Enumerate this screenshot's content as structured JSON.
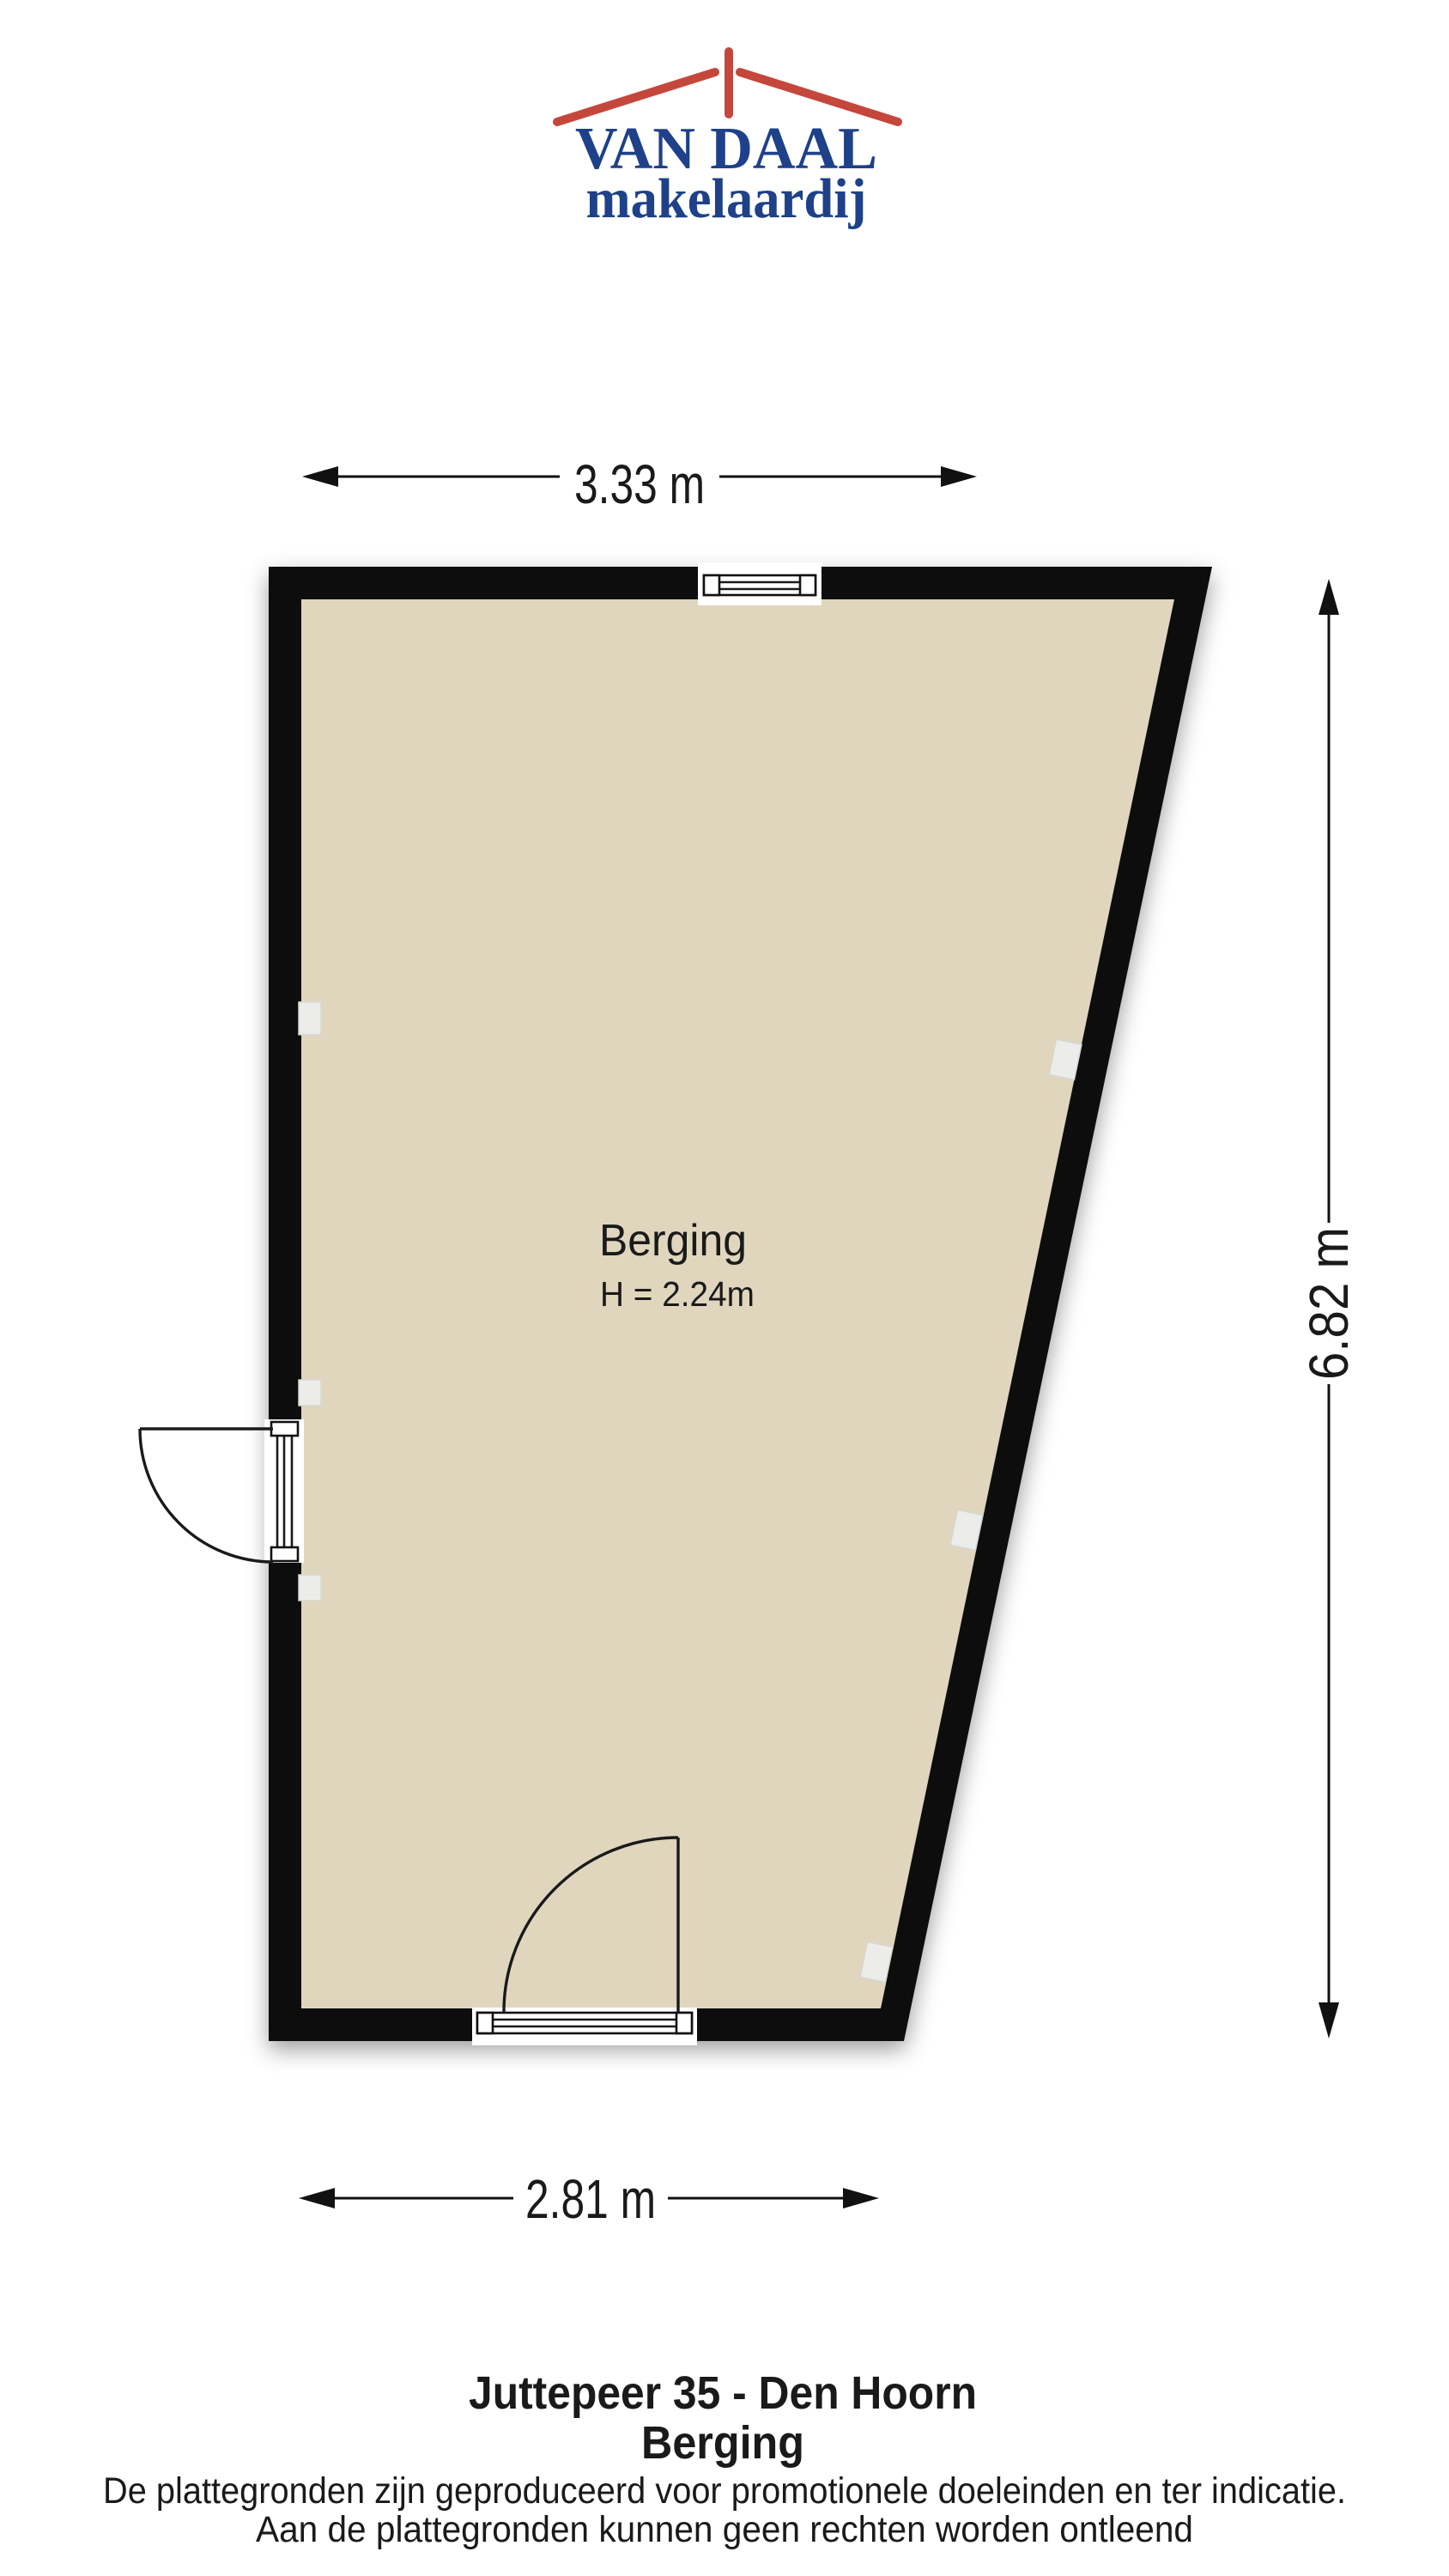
{
  "page": {
    "background": "#FFFFFF"
  },
  "logo": {
    "title": "VAN DAAL",
    "subtitle": "makelaardij",
    "colors": {
      "roof_red": "#C5473C",
      "text_blue": "#1E4189"
    }
  },
  "floorplan": {
    "room": {
      "name": "Berging",
      "ceiling_height": "H = 2.24m"
    },
    "dimensions": {
      "top": "3.33 m",
      "right": "6.82 m",
      "bottom": "2.81 m"
    },
    "colors": {
      "wall": "#0B0B0B",
      "floor": "#E0D6BE",
      "fixture": "#ECECEA"
    }
  },
  "footer": {
    "title_line1": "Juttepeer 35 - Den Hoorn",
    "title_line2": "Berging",
    "disclaimer_line1": "De plattegronden zijn geproduceerd voor promotionele doeleinden en ter indicatie.",
    "disclaimer_line2": "Aan de plattegronden kunnen geen rechten worden ontleend"
  }
}
